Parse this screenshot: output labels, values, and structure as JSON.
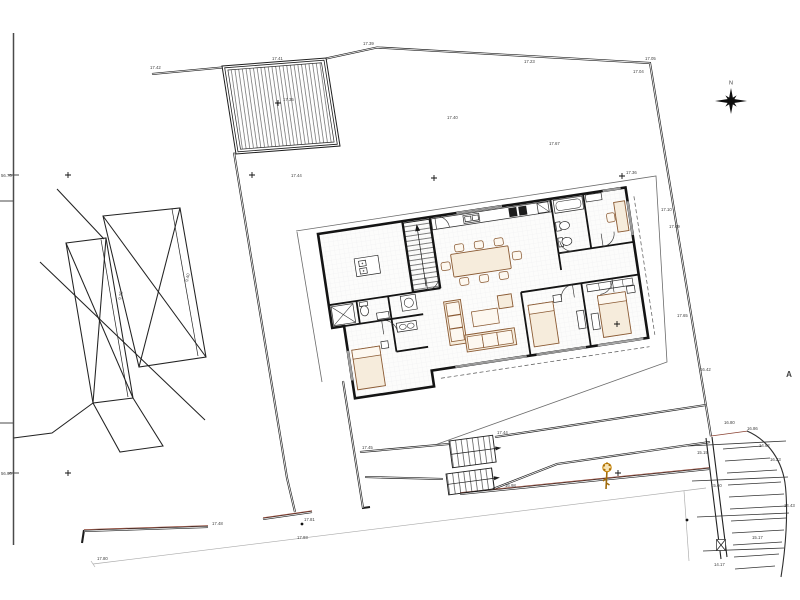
{
  "page": {
    "background": "#ffffff"
  },
  "colors": {
    "line": "#1f1f1f",
    "wall": "#141414",
    "furniture_accent": "#8a5a33",
    "terrain_accent": "#8a4232",
    "tree": "#c8860a",
    "faint_survey": "#aaaaaa"
  },
  "north": {
    "label": "N"
  },
  "section": {
    "label": "A"
  },
  "edge": {
    "left_top_level": "56.70",
    "left_bottom_level": "56.90"
  },
  "annotations": {
    "labels": [
      {
        "t": "17.42",
        "x": 150,
        "y": 69
      },
      {
        "t": "17.41",
        "x": 272,
        "y": 60
      },
      {
        "t": "17.39",
        "x": 363,
        "y": 45
      },
      {
        "t": "17.35",
        "x": 283,
        "y": 101
      },
      {
        "t": "17.23",
        "x": 524,
        "y": 63
      },
      {
        "t": "17.05",
        "x": 645,
        "y": 60
      },
      {
        "t": "17.04",
        "x": 633,
        "y": 73
      },
      {
        "t": "17.67",
        "x": 549,
        "y": 145
      },
      {
        "t": "17.36",
        "x": 626,
        "y": 174
      },
      {
        "t": "17.40",
        "x": 447,
        "y": 119
      },
      {
        "t": "17.44",
        "x": 291,
        "y": 177
      },
      {
        "t": "17.10",
        "x": 661,
        "y": 211
      },
      {
        "t": "17.09",
        "x": 669,
        "y": 228
      },
      {
        "t": "17.65",
        "x": 677,
        "y": 317
      },
      {
        "t": "16.42",
        "x": 700,
        "y": 371
      },
      {
        "t": "16.86",
        "x": 747,
        "y": 430
      },
      {
        "t": "16.80",
        "x": 724,
        "y": 424
      },
      {
        "t": "14.62",
        "x": 759,
        "y": 447
      },
      {
        "t": "16.23",
        "x": 770,
        "y": 461
      },
      {
        "t": "15.19",
        "x": 697,
        "y": 454
      },
      {
        "t": "15.60",
        "x": 711,
        "y": 487
      },
      {
        "t": "15.17",
        "x": 752,
        "y": 539
      },
      {
        "t": "14.17",
        "x": 714,
        "y": 566
      },
      {
        "t": "14.43",
        "x": 784,
        "y": 507
      },
      {
        "t": "17.80",
        "x": 97,
        "y": 560
      },
      {
        "t": "17.93",
        "x": 297,
        "y": 539
      },
      {
        "t": "17.48",
        "x": 212,
        "y": 525
      },
      {
        "t": "17.81",
        "x": 304,
        "y": 521
      },
      {
        "t": "17.45",
        "x": 362,
        "y": 449
      },
      {
        "t": "17.44",
        "x": 497,
        "y": 434
      },
      {
        "t": "16.98",
        "x": 505,
        "y": 487
      },
      {
        "t": "56.70",
        "x": 1,
        "y": 177
      },
      {
        "t": "56.90",
        "x": 1,
        "y": 475
      },
      {
        "t": "9.25",
        "x": 121,
        "y": 300,
        "r": -78
      },
      {
        "t": "9.40",
        "x": 188,
        "y": 282,
        "r": -78
      }
    ],
    "crosses": [
      [
        68,
        175
      ],
      [
        252,
        175
      ],
      [
        434,
        178
      ],
      [
        68,
        473
      ],
      [
        618,
        473
      ],
      [
        617,
        324
      ],
      [
        622,
        176
      ],
      [
        278,
        103
      ]
    ],
    "dots": [
      [
        302,
        524
      ],
      [
        687,
        520
      ]
    ]
  }
}
